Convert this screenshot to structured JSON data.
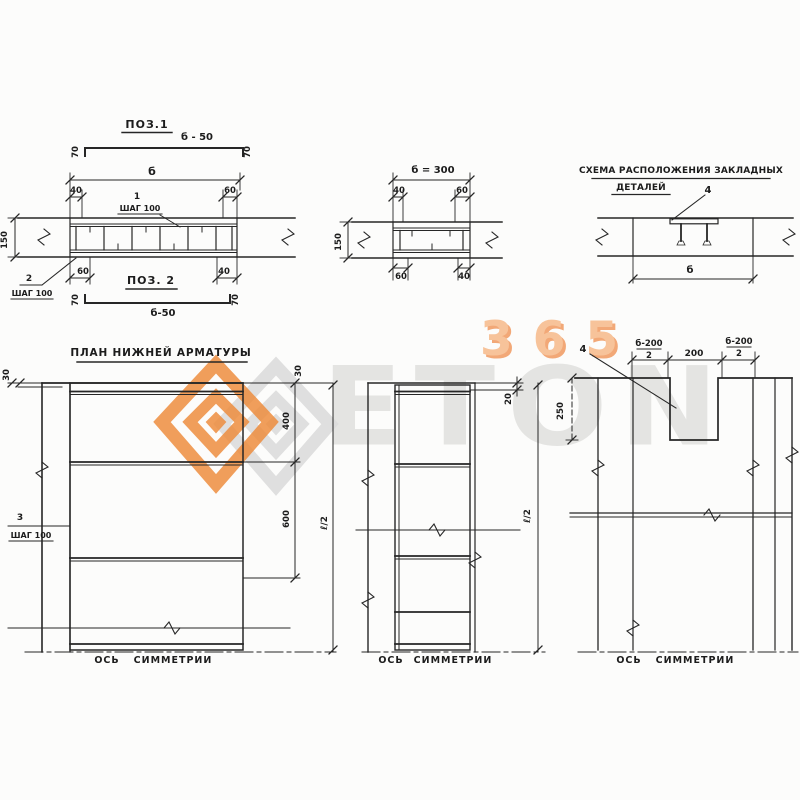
{
  "watermark": {
    "word": "ETON",
    "number": "365",
    "orange": "#ef8b3a",
    "gray": "#dcdcdc"
  },
  "sections": {
    "pos1": {
      "title": "ПОЗ.1",
      "length": "б - 50",
      "hook": "70"
    },
    "pos2": {
      "title": "ПОЗ. 2",
      "length": "б-50",
      "hook": "70"
    },
    "section_a": {
      "width": "б",
      "d40": "40",
      "d60": "60",
      "bar1": "1",
      "bar1_step": "ШАГ 100",
      "height": "150",
      "bar2": "2",
      "bar2_step": "ШАГ 100",
      "b60": "60",
      "b40": "40"
    },
    "section_b": {
      "width": "б = 300",
      "d40": "40",
      "d60": "60",
      "height": "150",
      "b60": "60",
      "b40": "40"
    },
    "scheme": {
      "title_line1": "СХЕМА РАСПОЛОЖЕНИЯ ЗАКЛАДНЫХ",
      "title_line2": "ДЕТАЛЕЙ",
      "detail": "4",
      "width": "б"
    }
  },
  "plans": {
    "left": {
      "title": "ПЛАН НИЖНЕЙ АРМАТУРЫ",
      "d30_left": "30",
      "d30_right": "30",
      "d400": "400",
      "d600": "600",
      "d_half": "ℓ/2",
      "bar3": "3",
      "bar3_step": "ШАГ 100",
      "axis_word1": "ОСЬ",
      "axis_word2": "СИММЕТРИИ"
    },
    "middle": {
      "d20": "20",
      "d_half": "ℓ/2",
      "axis_word1": "ОСЬ",
      "axis_word2": "СИММЕТРИИ"
    },
    "right": {
      "detail": "4",
      "frac_left_num": "б-200",
      "frac_left_den": "2",
      "d200": "200",
      "frac_right_num": "б-200",
      "frac_right_den": "2",
      "d250": "250",
      "axis_word1": "ОСЬ",
      "axis_word2": "СИММЕТРИИ"
    }
  }
}
